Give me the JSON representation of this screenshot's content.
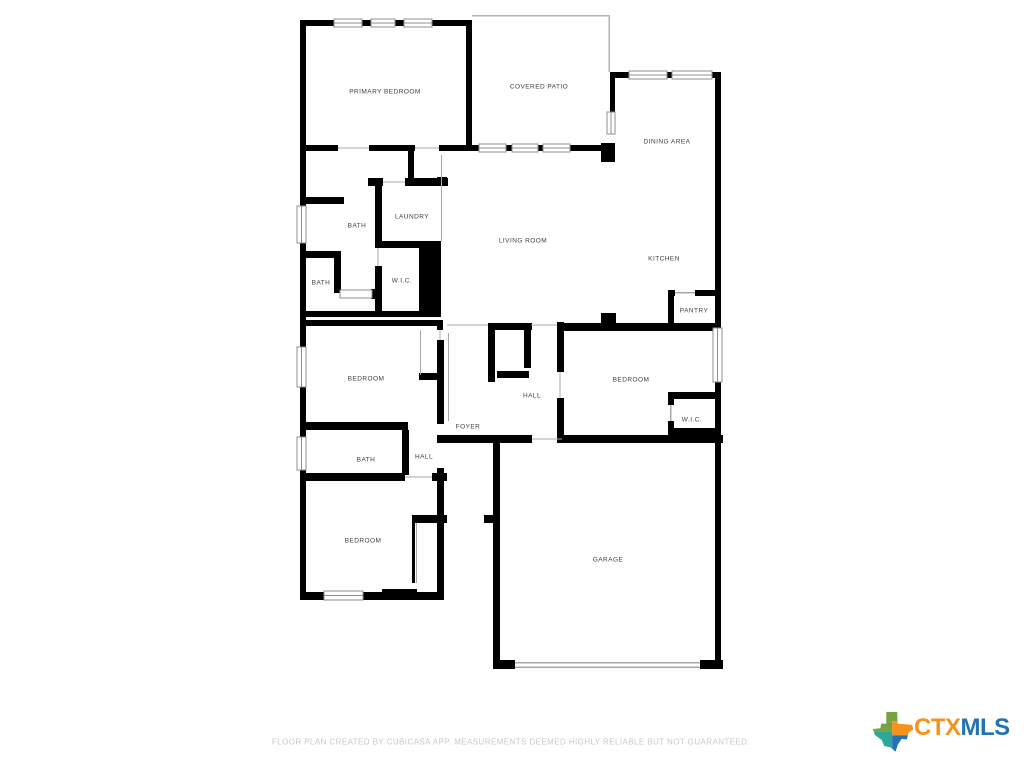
{
  "floor_plan": {
    "wall_color": "#000000",
    "label_color": "#3c4043",
    "rooms": [
      {
        "id": "primary-bedroom",
        "label": "PRIMARY BEDROOM"
      },
      {
        "id": "covered-patio",
        "label": "COVERED PATIO"
      },
      {
        "id": "dining-area",
        "label": "DINING AREA"
      },
      {
        "id": "bath-upper",
        "label": "BATH"
      },
      {
        "id": "laundry",
        "label": "LAUNDRY"
      },
      {
        "id": "living-room",
        "label": "LIVING ROOM"
      },
      {
        "id": "kitchen",
        "label": "KITCHEN"
      },
      {
        "id": "bath-middle",
        "label": "BATH"
      },
      {
        "id": "wic-left",
        "label": "W.I.C."
      },
      {
        "id": "pantry",
        "label": "PANTRY"
      },
      {
        "id": "bedroom-left",
        "label": "BEDROOM"
      },
      {
        "id": "hall-center",
        "label": "HALL"
      },
      {
        "id": "bedroom-right",
        "label": "BEDROOM"
      },
      {
        "id": "foyer",
        "label": "FOYER"
      },
      {
        "id": "wic-right",
        "label": "W.I.C."
      },
      {
        "id": "bath-lower",
        "label": "BATH"
      },
      {
        "id": "hall-lower",
        "label": "HALL"
      },
      {
        "id": "bedroom-bottom",
        "label": "BEDROOM"
      },
      {
        "id": "garage",
        "label": "GARAGE"
      }
    ]
  },
  "footer": {
    "disclaimer": "FLOOR PLAN CREATED BY CUBICASA APP. MEASUREMENTS DEEMED HIGHLY RELIABLE BUT NOT GUARANTEED."
  },
  "logo": {
    "text_ctx": "CTX",
    "text_mls": "MLS",
    "ctx_color": "#F6921E",
    "mls_color": "#2173B4",
    "texas_icon_colors": {
      "green": "#76A240",
      "orange": "#F6921E",
      "teal": "#2EA79B",
      "blue": "#2173B4"
    }
  }
}
